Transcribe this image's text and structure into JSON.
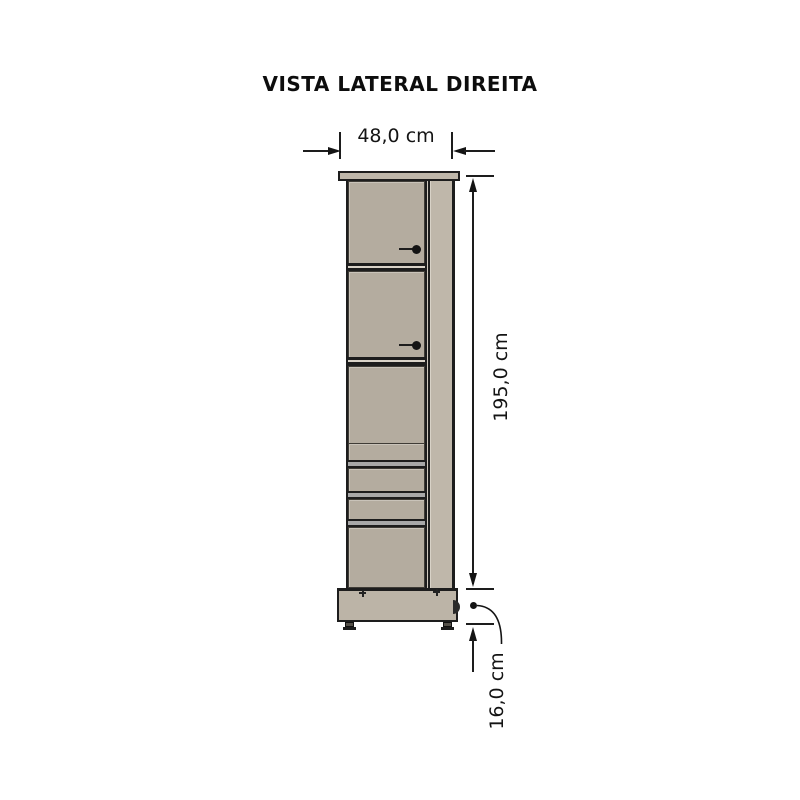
{
  "title": "VISTA LATERAL DIREITA",
  "dimensions": {
    "width_label": "48,0 cm",
    "height_label": "195,0 cm",
    "base_height_label": "16,0 cm"
  },
  "colors": {
    "background": "#ffffff",
    "outline": "#1d1d1d",
    "panel": "#b4ac9f",
    "panel_light": "#bfb7aa",
    "panel_base": "#bcb4a7",
    "band_gray": "#a8a8a8",
    "band_light": "#d9d3c8"
  }
}
